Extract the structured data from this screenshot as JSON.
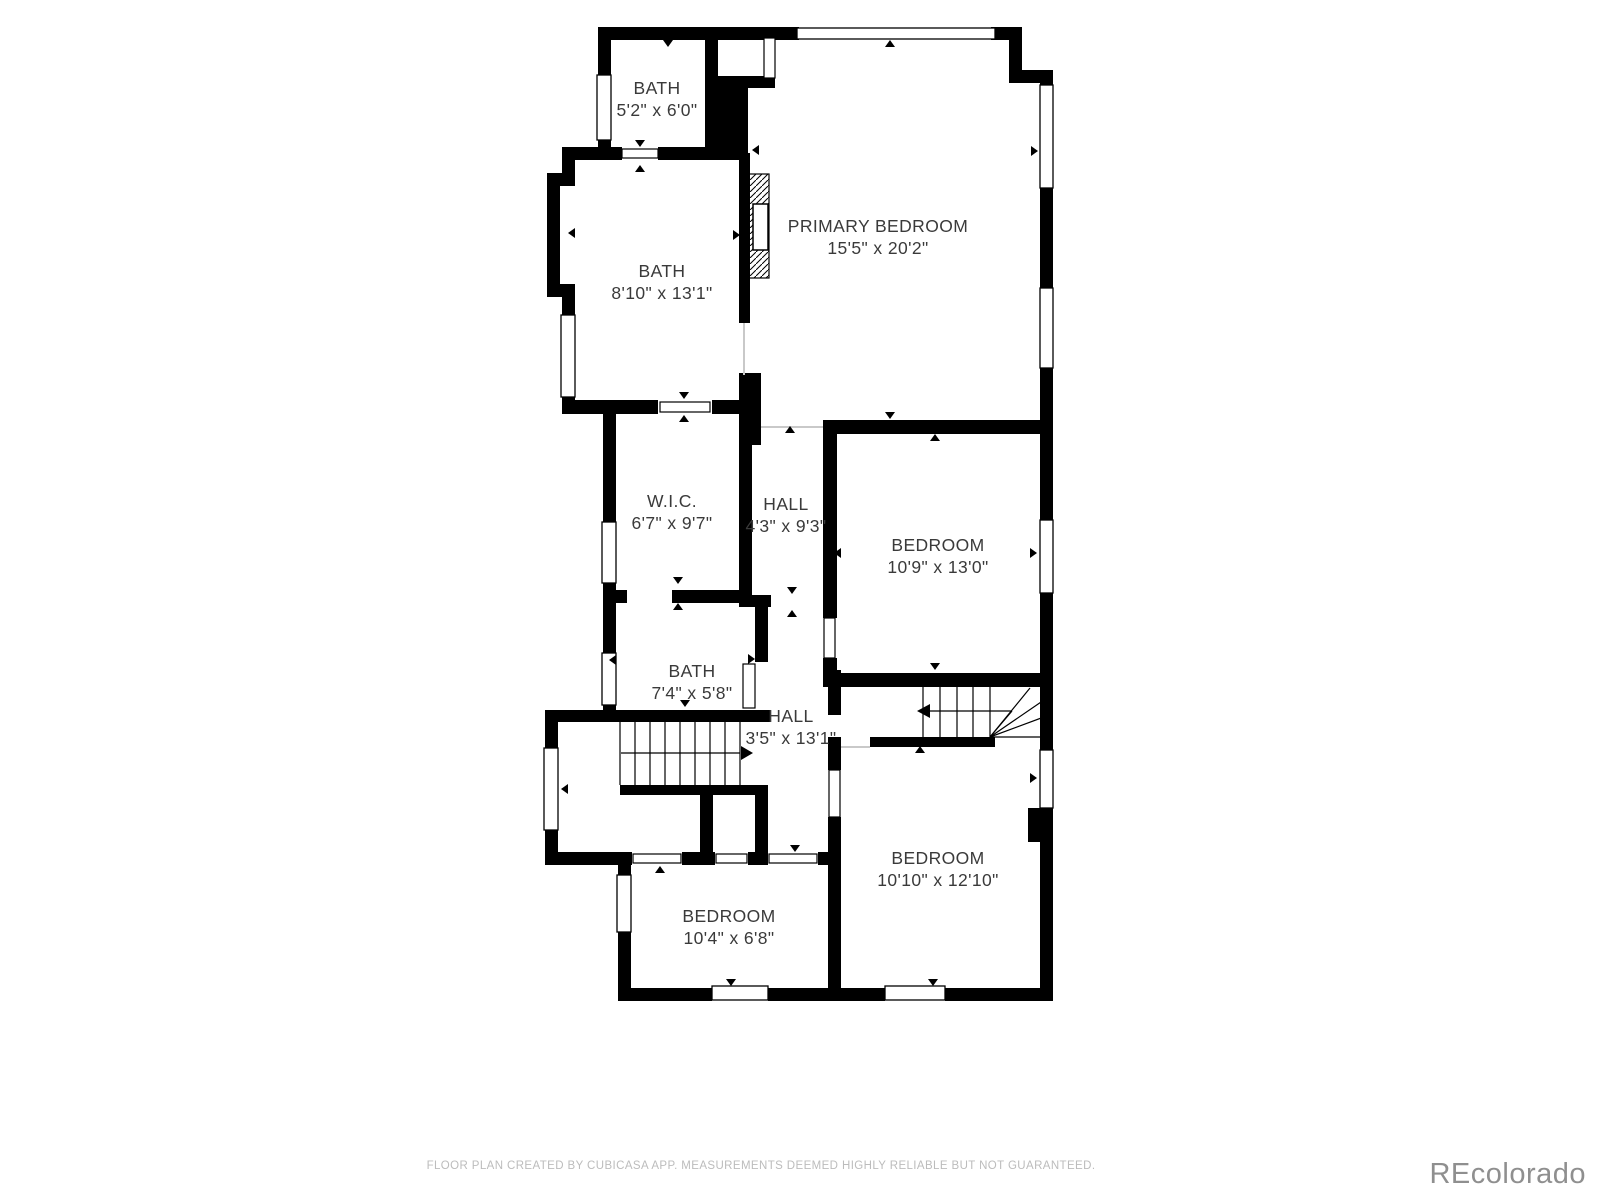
{
  "floor_plan": {
    "rooms": [
      {
        "name": "BATH",
        "dims": "5'2\" x 6'0\"",
        "x": 657,
        "y": 99
      },
      {
        "name": "BATH",
        "dims": "8'10\" x 13'1\"",
        "x": 662,
        "y": 282
      },
      {
        "name": "PRIMARY BEDROOM",
        "dims": "15'5\" x 20'2\"",
        "x": 878,
        "y": 237
      },
      {
        "name": "W.I.C.",
        "dims": "6'7\" x 9'7\"",
        "x": 672,
        "y": 512
      },
      {
        "name": "HALL",
        "dims": "4'3\" x 9'3\"",
        "x": 786,
        "y": 515
      },
      {
        "name": "BEDROOM",
        "dims": "10'9\" x 13'0\"",
        "x": 938,
        "y": 556
      },
      {
        "name": "BATH",
        "dims": "7'4\" x 5'8\"",
        "x": 692,
        "y": 682
      },
      {
        "name": "HALL",
        "dims": "3'5\" x 13'1\"",
        "x": 791,
        "y": 727
      },
      {
        "name": "BEDROOM",
        "dims": "10'10\" x 12'10\"",
        "x": 938,
        "y": 869
      },
      {
        "name": "BEDROOM",
        "dims": "10'4\" x 6'8\"",
        "x": 729,
        "y": 927
      }
    ],
    "footer": {
      "text": "FLOOR PLAN CREATED BY CUBICASA APP. MEASUREMENTS DEEMED HIGHLY RELIABLE BUT NOT GUARANTEED."
    },
    "watermark": {
      "text": "REcolorado"
    },
    "colors": {
      "wall": "#000000",
      "background": "#ffffff",
      "label_text": "#3a3a3a",
      "footer_text": "#bcbcbc",
      "watermark_text": "#8f8f8f",
      "open_boundary": "#c9c9c9"
    }
  }
}
